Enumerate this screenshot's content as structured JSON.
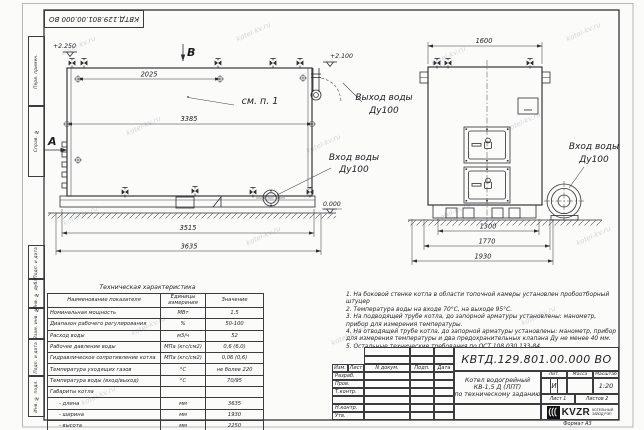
{
  "watermark": {
    "text": "kotel-kv.ru"
  },
  "frame": {
    "top_stamp": "КВТД.129.801.00.000  ВО",
    "left_strips": [
      "Перв. примен.",
      "Справ. №",
      "Подп. и дата",
      "Инв. № дубл.",
      "Взам. инв. №",
      "Подп. и дата",
      "Инв. № подл."
    ],
    "format_note": "Формат   А3"
  },
  "side_view": {
    "label_a": "А",
    "label_b": "В",
    "see_note": "см. п. 1",
    "elev_top_left": "+2.250",
    "elev_top_right": "+2.100",
    "elev_zero": "0.000",
    "dim_2025": "2025",
    "dim_3385": "3385",
    "dim_3515": "3515",
    "dim_3635": "3635"
  },
  "front_view": {
    "dim_1600": "1600",
    "dim_1300": "1300",
    "dim_1770": "1770",
    "dim_1930": "1930"
  },
  "callouts": {
    "outlet_line1": "Выход воды",
    "outlet_line2": "Ду100",
    "inlet_side_line1": "Вход воды",
    "inlet_side_line2": "Ду100",
    "inlet_front_line1": "Вход воды",
    "inlet_front_line2": "Ду100"
  },
  "tech_table": {
    "title": "Техническая характеристика",
    "headers": [
      "Наименование показателя",
      "Единицы измерения",
      "Значение"
    ],
    "rows": [
      [
        "Номинальная мощность",
        "МВт",
        "1,5"
      ],
      [
        "Диапазон рабочего регулирования",
        "%",
        "50-100"
      ],
      [
        "Расход воды",
        "м3/ч",
        "52"
      ],
      [
        "Рабочее давление воды",
        "МПа (кгс/см2)",
        "0,6 (6,0)"
      ],
      [
        "Гидравлическое сопротивление котла",
        "МПа (кгс/см2)",
        "0,06 (0,6)"
      ],
      [
        "Температура уходящих газов",
        "°С",
        "не более 220"
      ],
      [
        "Температура воды (вход/выход)",
        "°С",
        "70/95"
      ],
      [
        "Габариты котла",
        "",
        ""
      ],
      [
        "- длина",
        "мм",
        "3635"
      ],
      [
        "- ширина",
        "мм",
        "1930"
      ],
      [
        "- высота",
        "мм",
        "2250"
      ]
    ]
  },
  "notes": [
    "1.  На боковой стенке котла в области топочной камеры установлен пробоотборный штуцер",
    "2.  Температура воды на входе 70°С, на выходе 95°С.",
    "3.  На подводящей трубе котла, до запорной арматуры установлены: манометр, прибор для измерения температуры.",
    "4.  На отводящей трубе котла, до запорной арматуры установлены: манометр, прибор для измерения температуры и два предохранительных клапана Ду не менее 40 мм.",
    "5.  Остальные технические требования по ОСТ 108.030.133-84."
  ],
  "title_block": {
    "doc_number": "КВТД.129.801.00.000  ВО",
    "product_line1": "Котел водогрейный",
    "product_line2": "КВ-1,5 Д (ЛПТ)",
    "product_line3": "по техническому заданию",
    "col_izm": "Изм.",
    "col_list": "Лист",
    "col_doc": "N докум.",
    "col_podp": "Подп.",
    "col_data": "Дата",
    "row_razrab": "Разраб.",
    "row_prov": "Пров.",
    "row_tkontr": "Т.контр.",
    "row_nkontr": "Н.контр.",
    "row_utv": "Утв.",
    "lit_label": "Лит.",
    "mass_label": "Масса",
    "scale_label": "Масштаб",
    "lit_value": "И",
    "scale_value": "1:20",
    "sheet_label": "Лист  1",
    "sheets_label": "Листов  2",
    "logo_text": "KVZR",
    "company_line1": "КОТЕЛЬНЫЙ",
    "company_line2": "ЗАВОД РЭП"
  }
}
